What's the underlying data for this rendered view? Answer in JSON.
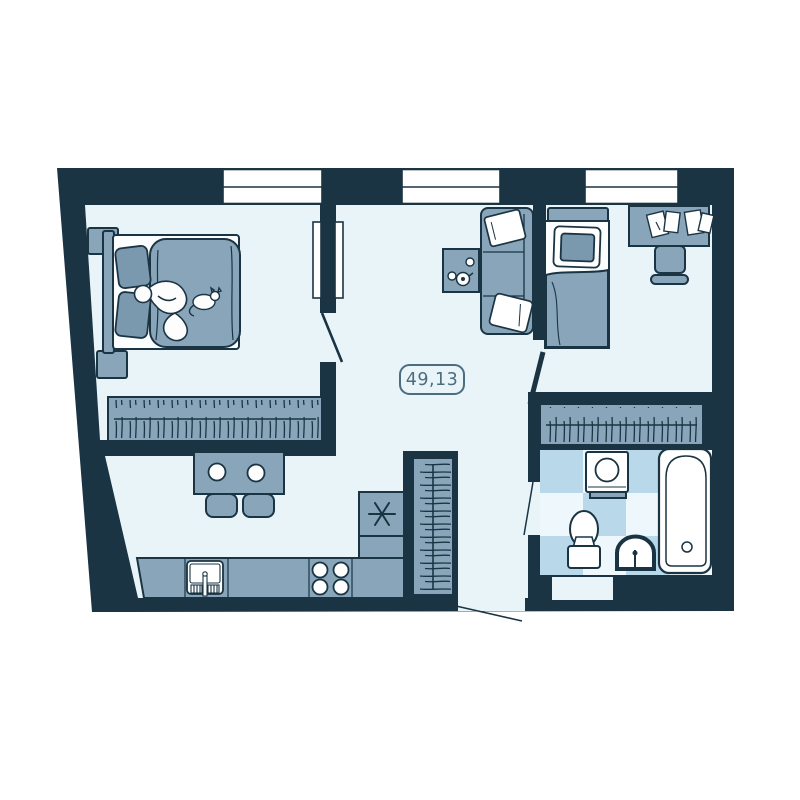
{
  "floorplan": {
    "area_label": "49,13",
    "colors": {
      "wall": "#1a3443",
      "furniture": "#88a5ba",
      "furniture_shadow": "#7a98ae",
      "floor": "#e9f4f9",
      "tile_blue": "#b9d9ea",
      "tile_light": "#eef7fb",
      "fixture_white": "#ffffff",
      "label": "#4c6d7d",
      "background": "#ffffff"
    },
    "window_count": 3,
    "furniture_icons": [
      "double-bed-icon",
      "sleeping-person-icon",
      "cat-icon",
      "nightstand-icon",
      "wardrobe-hangers-icon",
      "balcony-door-icon",
      "sofa-icon",
      "coffee-table-icon",
      "teapot-icon",
      "cup-icon",
      "single-bed-icon",
      "desk-icon",
      "papers-icon",
      "desk-chair-icon",
      "hall-closet-icon",
      "tall-cabinet-icon",
      "refrigerator-snowflake-icon",
      "kitchen-counter-icon",
      "kitchen-sink-icon",
      "stove-burners-icon",
      "dining-table-icon",
      "plate-icon",
      "chair-icon",
      "washing-machine-icon",
      "toilet-icon",
      "bathroom-sink-icon",
      "bathtub-icon",
      "window-icon",
      "door-swing-icon"
    ]
  }
}
